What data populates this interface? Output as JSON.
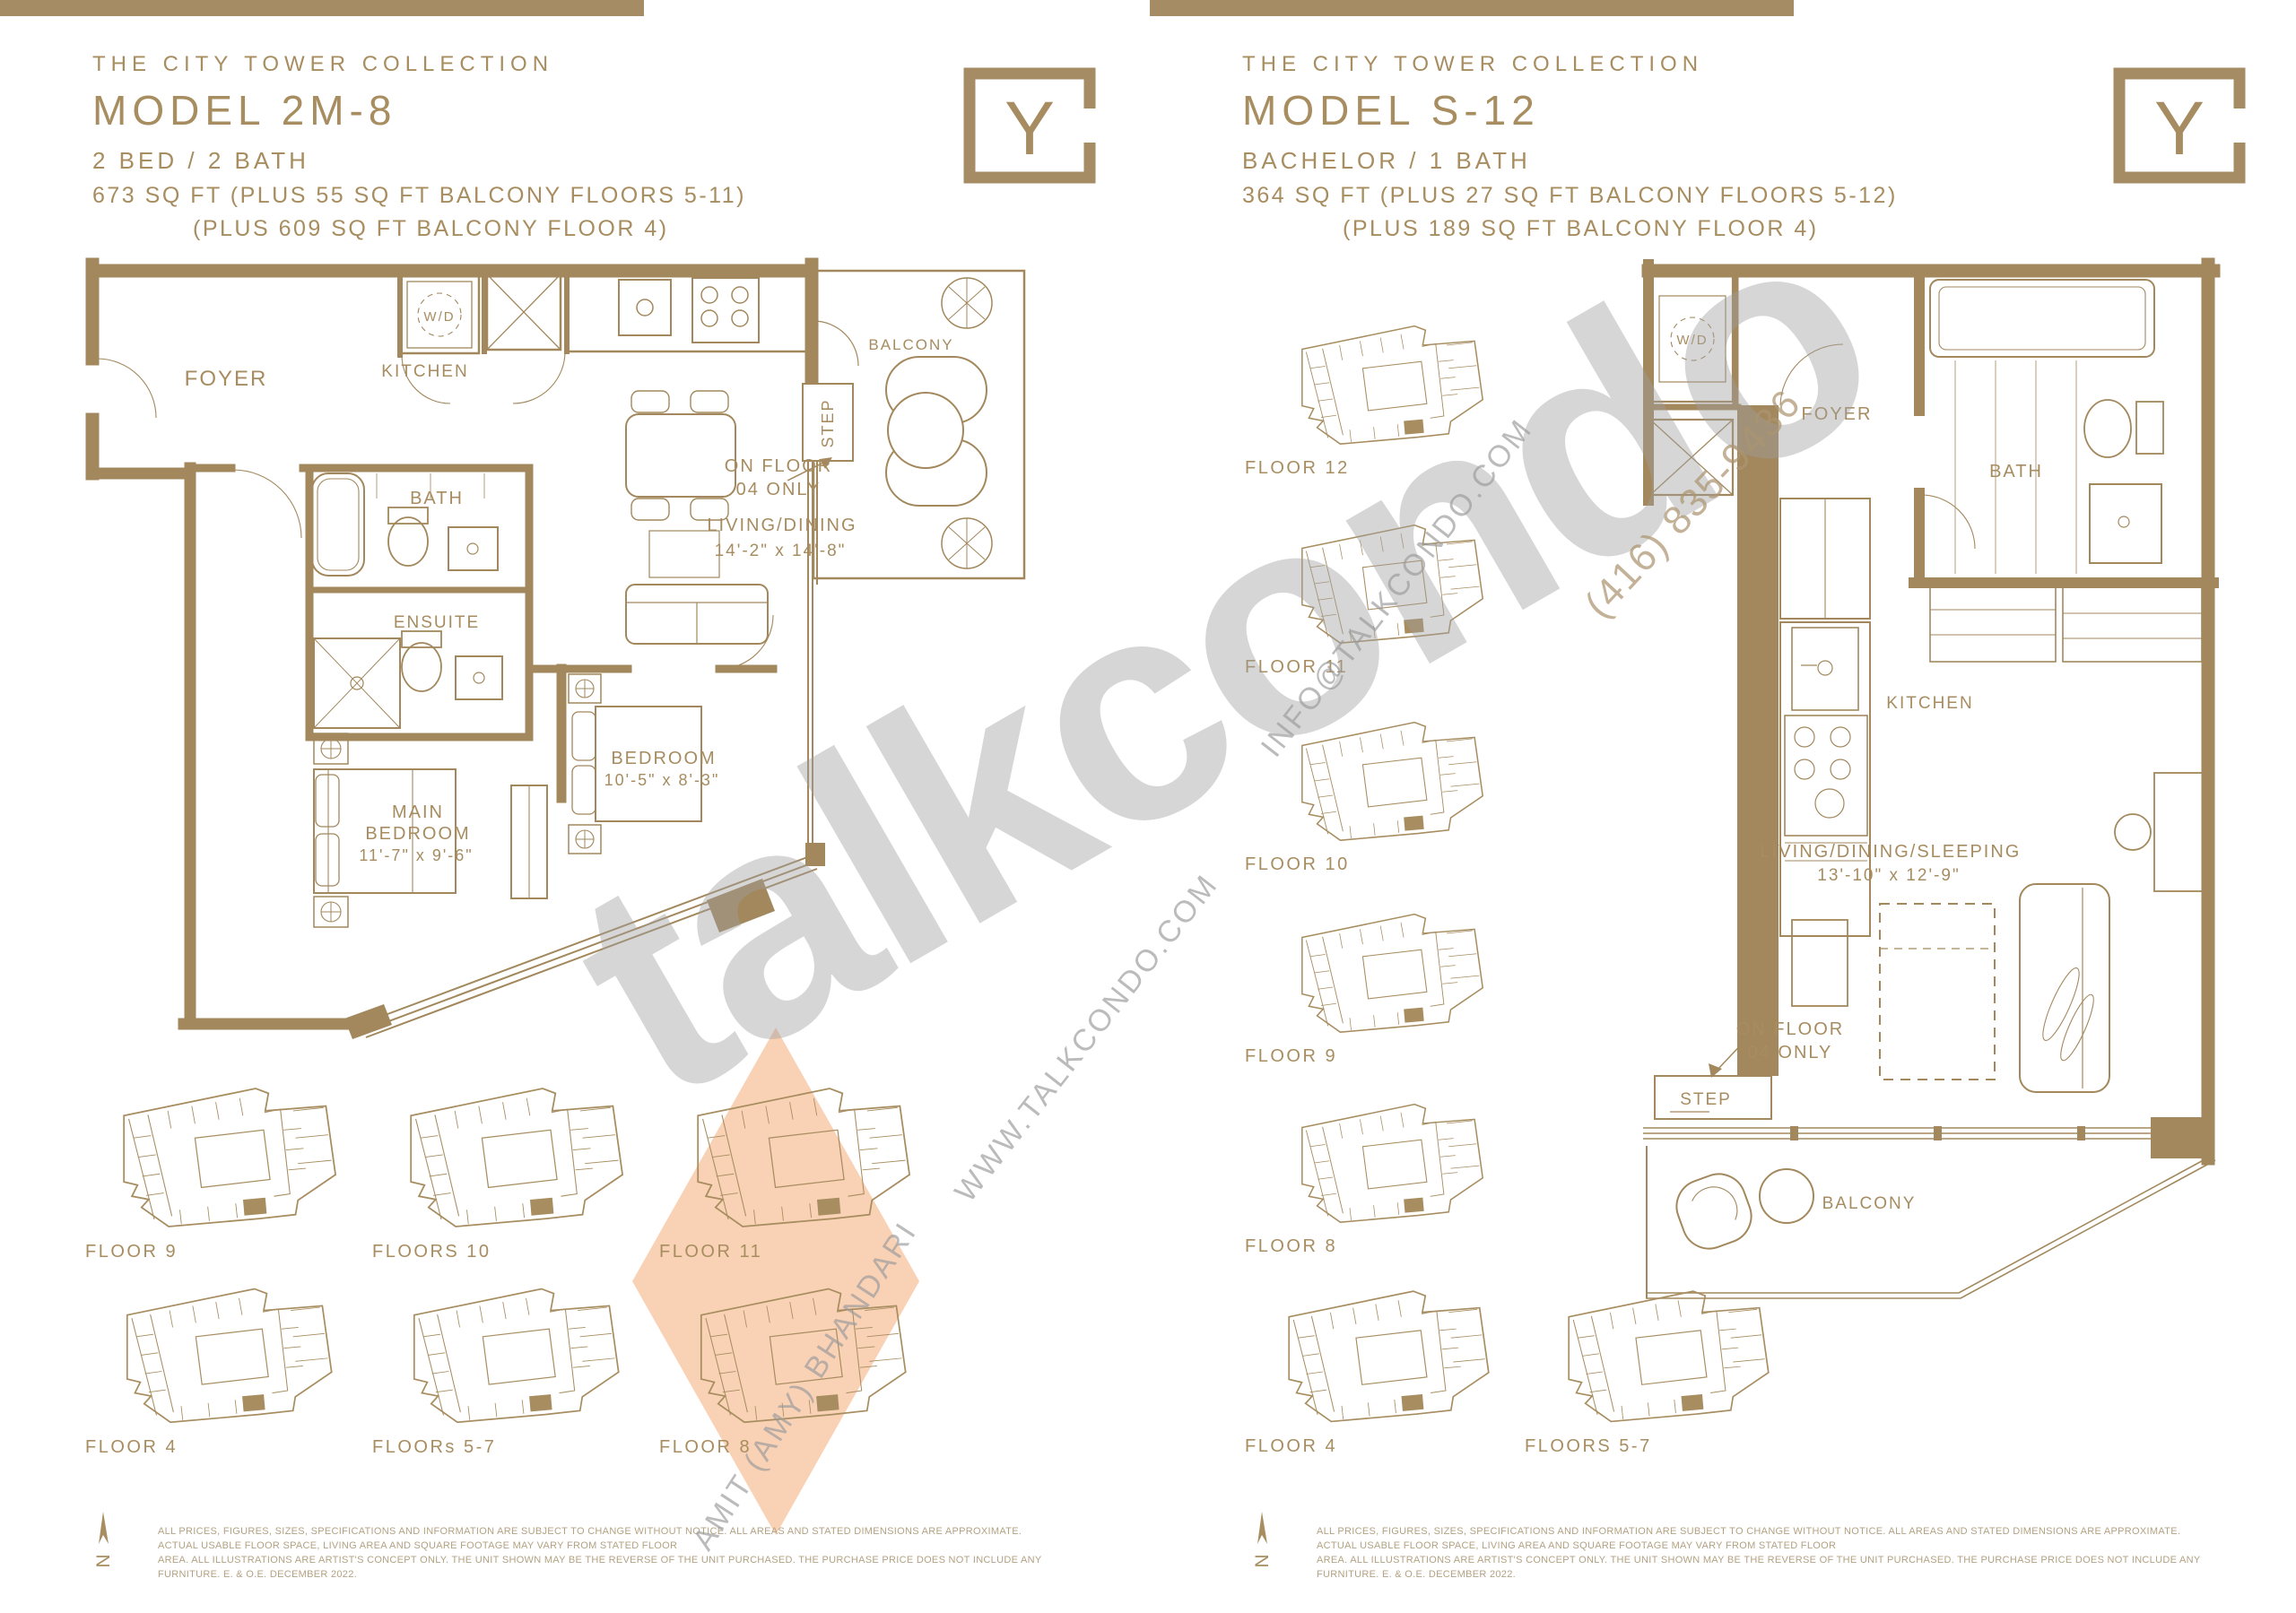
{
  "page": {
    "bar_color": "#a58c64",
    "logo_letter": "Y",
    "watermark": {
      "brand": "talkcondo",
      "website": "WWW.TALKCONDO.COM",
      "email": "INFO@TALKCONDO.COM",
      "phone": "(416) 835-9436",
      "agent": "AMIT (AMY) BHANDARI"
    }
  },
  "left_unit": {
    "collection": "THE CITY TOWER COLLECTION",
    "model": "MODEL 2M-8",
    "type": "2 BED / 2 BATH",
    "area_line1": "673 SQ FT (PLUS 55 SQ FT BALCONY FLOORS 5-11)",
    "area_line2": "(PLUS 609 SQ FT BALCONY FLOOR 4)",
    "plan": {
      "foyer": "FOYER",
      "wd": "W/D",
      "kitchen": "KITCHEN",
      "bath": "BATH",
      "ensuite": "ENSUITE",
      "balcony": "BALCONY",
      "step": "STEP",
      "on_floor_l1": "ON FLOOR",
      "on_floor_l2": "04 ONLY",
      "living_l1": "LIVING/DINING",
      "living_l2": "14'-2\" x 14'-8\"",
      "main_l1": "MAIN",
      "main_l2": "BEDROOM",
      "main_l3": "11'-7\" x 9'-6\"",
      "bed_l1": "BEDROOM",
      "bed_l2": "10'-5\" x 8'-3\""
    },
    "keyplans": [
      {
        "label": "FLOOR 9"
      },
      {
        "label": "FLOORS 10"
      },
      {
        "label": "FLOOR 11"
      },
      {
        "label": "FLOOR 4"
      },
      {
        "label": "FLOORs 5-7"
      },
      {
        "label": "FLOOR 8"
      }
    ]
  },
  "right_unit": {
    "collection": "THE CITY TOWER COLLECTION",
    "model": "MODEL S-12",
    "type": "BACHELOR / 1 BATH",
    "area_line1": "364 SQ FT (PLUS 27 SQ FT BALCONY FLOORS 5-12)",
    "area_line2": "(PLUS 189 SQ FT BALCONY FLOOR 4)",
    "plan": {
      "wd": "W/D",
      "foyer": "FOYER",
      "bath": "BATH",
      "kitchen": "KITCHEN",
      "living_l1": "LIVING/DINING/SLEEPING",
      "living_l2": "13'-10\" x 12'-9\"",
      "on_floor_l1": "ON FLOOR",
      "on_floor_l2": "04 ONLY",
      "step": "STEP",
      "balcony": "BALCONY"
    },
    "keyplans": [
      {
        "label": "FLOOR 12"
      },
      {
        "label": "FLOOR 11"
      },
      {
        "label": "FLOOR 10"
      },
      {
        "label": "FLOOR 9"
      },
      {
        "label": "FLOOR 8"
      },
      {
        "label": "FLOOR 4"
      },
      {
        "label": "FLOORS 5-7"
      }
    ]
  },
  "footer": {
    "north_letter": "N",
    "disclaimer_line1": "ALL PRICES, FIGURES, SIZES, SPECIFICATIONS AND INFORMATION ARE SUBJECT TO CHANGE WITHOUT NOTICE. ALL AREAS AND STATED DIMENSIONS ARE APPROXIMATE. ACTUAL USABLE FLOOR SPACE, LIVING AREA AND SQUARE FOOTAGE MAY VARY FROM STATED FLOOR",
    "disclaimer_line2": "AREA. ALL ILLUSTRATIONS ARE ARTIST'S CONCEPT ONLY. THE UNIT SHOWN MAY BE THE REVERSE OF THE UNIT PURCHASED. THE PURCHASE PRICE DOES NOT INCLUDE ANY FURNITURE. E. & O.E. DECEMBER 2022."
  }
}
